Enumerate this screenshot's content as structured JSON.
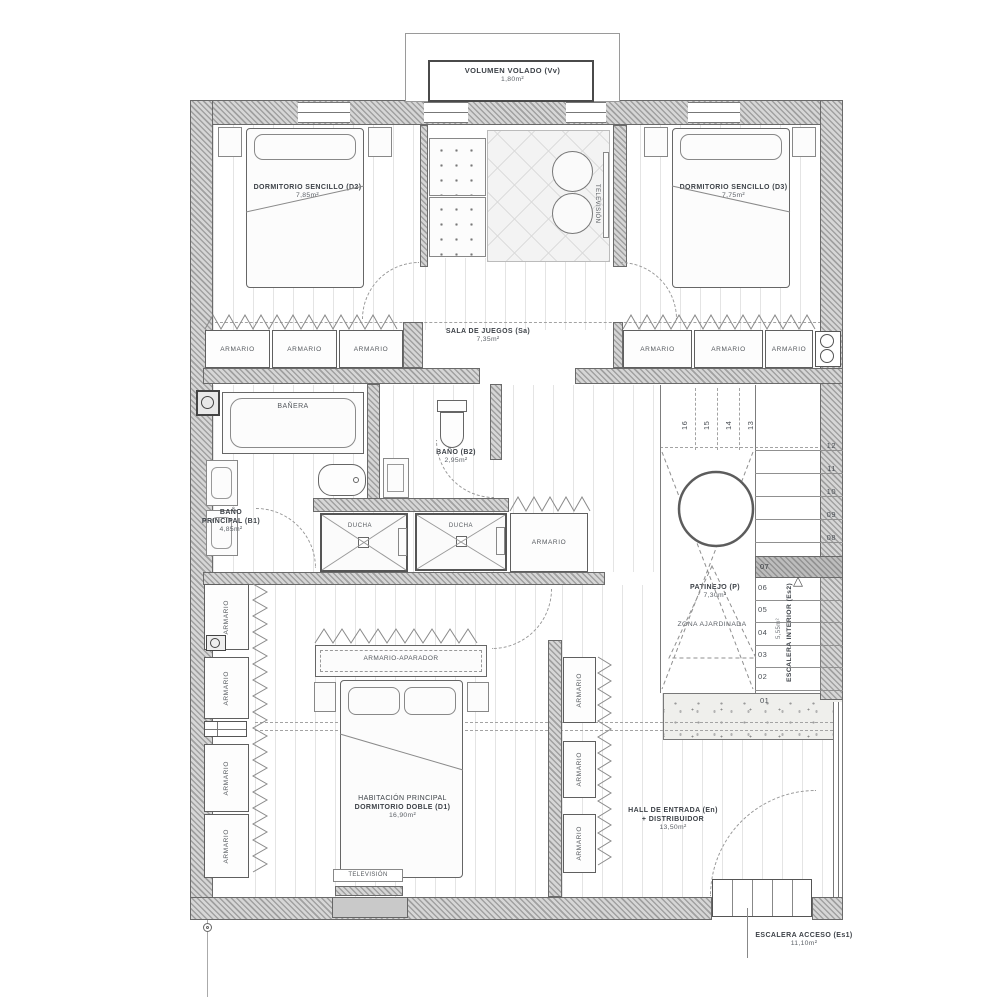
{
  "plan": {
    "labels": {
      "volumen_name": "VOLUMEN VOLADO (Vv)",
      "volumen_area": "1,80m²",
      "d2_name": "DORMITORIO SENCILLO (D2)",
      "d2_area": "7,85m²",
      "d3_name": "DORMITORIO SENCILLO (D3)",
      "d3_area": "7,75m²",
      "sala_name": "SALA DE JUEGOS (Sa)",
      "sala_area": "7,35m²",
      "television": "TELEVISIÓN",
      "armario": "ARMARIO",
      "banera": "BAÑERA",
      "b1_l1": "BAÑO",
      "b1_l2": "PRINCIPAL (B1)",
      "b1_area": "4,85m²",
      "b2_name": "BAÑO (B2)",
      "b2_area": "2,95m²",
      "ducha": "DUCHA",
      "aparador": "ARMARIO-APARADOR",
      "d1_l1": "HABITACIÓN PRINCIPAL",
      "d1_l2": "DORMITORIO DOBLE (D1)",
      "d1_area": "16,90m²",
      "patinejo_name": "PATINEJO (P)",
      "patinejo_area": "7,30m²",
      "zona": "ZONA AJARDINADA",
      "es2_name": "ESCALERA INTERIOR (Es2)",
      "es2_area": "5,55m²",
      "hall_l1": "HALL DE ENTRADA (En)",
      "hall_l2": "+ DISTRIBUIDOR",
      "hall_area": "13,50m²",
      "es1_name": "ESCALERA ACCESO (Es1)",
      "es1_area": "11,10m²"
    },
    "stairs": {
      "upper": [
        "16",
        "15",
        "14",
        "13"
      ],
      "mid": [
        "12",
        "11",
        "10",
        "09",
        "08"
      ],
      "lower": [
        "07",
        "06",
        "05",
        "04",
        "03",
        "02",
        "01"
      ]
    },
    "colors": {
      "wall_fill": "#d6d6d6",
      "line": "#666666",
      "text": "#3d4248",
      "floor_line": "#e4e4e4"
    }
  }
}
